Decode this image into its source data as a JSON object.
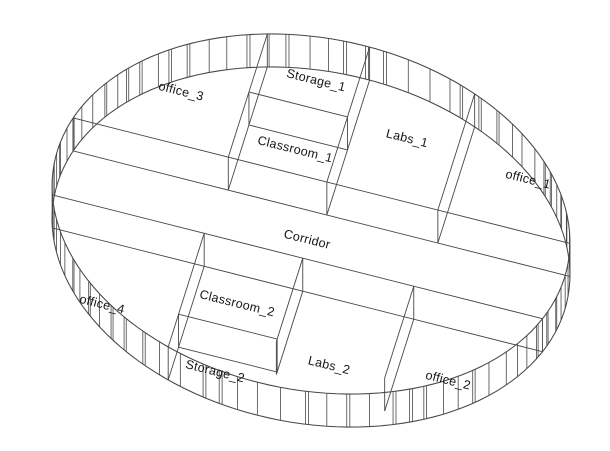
{
  "page": {
    "background": "#ffffff"
  },
  "drawing": {
    "type": "axonometric-circular-floorplan",
    "line_color": "#474747",
    "label_color": "#161616",
    "label_rotation_deg": 14
  },
  "rooms": [
    {
      "id": "office_3",
      "label": "office_3"
    },
    {
      "id": "storage_1",
      "label": "Storage_1"
    },
    {
      "id": "classroom_1",
      "label": "Classroom_1"
    },
    {
      "id": "labs_1",
      "label": "Labs_1"
    },
    {
      "id": "office_1",
      "label": "office_1"
    },
    {
      "id": "corridor",
      "label": "Corridor"
    },
    {
      "id": "office_4",
      "label": "office_4"
    },
    {
      "id": "classroom_2",
      "label": "Classroom_2"
    },
    {
      "id": "storage_2",
      "label": "Storage_2"
    },
    {
      "id": "labs_2",
      "label": "Labs_2"
    },
    {
      "id": "office_2",
      "label": "office_2"
    }
  ]
}
